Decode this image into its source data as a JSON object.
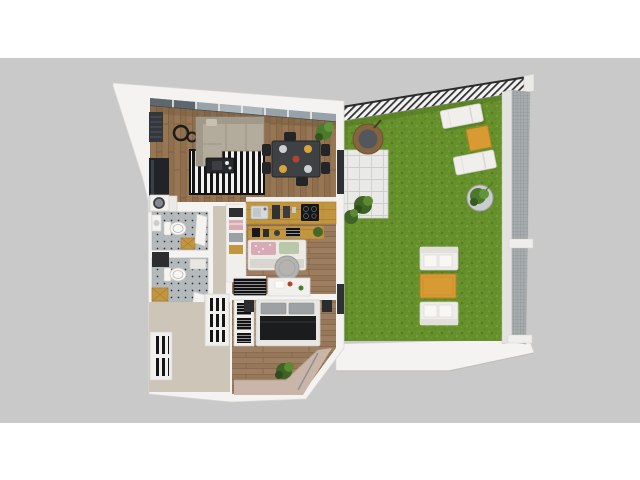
{
  "scene": {
    "type": "3d-floor-plan-render",
    "view": "top-down",
    "subject": "apartment floor plan with private garden terrace",
    "canvas": {
      "width": 640,
      "height": 480
    }
  },
  "palette": {
    "page_white": "#ffffff",
    "background_gray": "#c9c9c9",
    "wall_white": "#f4f3f1",
    "wall_edge": "#d8d6d2",
    "wood_floor": "#8f6f4e",
    "wood_floor_line": "#76593c",
    "bedroom_floor": "#97775a",
    "bedroom_floor_line": "#7d6046",
    "counter_wood": "#c2963f",
    "counter_wood_line": "#a87c2f",
    "sofa_beige": "#b3ac9c",
    "sofa_beige_dark": "#a19a8a",
    "rug_black": "#161616",
    "rug_white": "#f2f2f2",
    "table_dark": "#3f4245",
    "chair_dark": "#232527",
    "glazing_gray": "#98a2a9",
    "glazing_dark": "#5e676e",
    "bathroom_tile": "#b4b9bc",
    "bathroom_dot": "#2c2e30",
    "entry_floor": "#cdc5b8",
    "terrace_tan": "#c9b6a8",
    "lawn_green": "#66902c",
    "lawn_dark": "#567c22",
    "lawn_light": "#74a238",
    "patio_tile": "#e9e9e7",
    "patio_line": "#cfcfcc",
    "fence_white": "#f2f2f2",
    "fence_hatch": "#2e2e2e",
    "wall_mesh": "#a7acaf",
    "wall_mesh_line": "#82888c",
    "accent_orange": "#d89a33",
    "plant_green": "#4c7a2c",
    "plant_green_light": "#63943a",
    "plant_green_dark": "#35541d",
    "duvet_black": "#1b1c1e",
    "pillow_pink": "#d8aab4",
    "pillow_green": "#b9c9a8"
  },
  "apartment": {
    "rooms": [
      {
        "name": "living-room",
        "floor": "wood-planks",
        "items": [
          "corner-sofa",
          "striped-rug",
          "coffee-table",
          "dining-table",
          "dining-chairs-6",
          "wall-tv",
          "tv-cabinet",
          "radiator",
          "wall-art-rings",
          "potted-plant",
          "full-width-window"
        ]
      },
      {
        "name": "kitchen",
        "items": [
          "wood-counter",
          "sink",
          "cooktop",
          "small-appliances"
        ]
      },
      {
        "name": "bedroom",
        "floor": "wood-planks",
        "items": [
          "double-bed",
          "floral-pillow",
          "green-pillow",
          "wall-shelf",
          "closet",
          "desk",
          "round-rug",
          "bookshelf"
        ]
      },
      {
        "name": "bathroom-top",
        "floor": "dotted-tile",
        "items": [
          "toilet",
          "washbasin",
          "washing-machine",
          "wooden-laundry-box",
          "door"
        ]
      },
      {
        "name": "bathroom-bottom",
        "floor": "dotted-tile",
        "items": [
          "toilet",
          "shower-mat",
          "shelf",
          "wooden-laundry-box",
          "door"
        ]
      },
      {
        "name": "hallway-entry",
        "floor": "beige",
        "items": [
          "wardrobe-rack-1",
          "wardrobe-rack-2"
        ]
      },
      {
        "name": "second-bedroom",
        "floor": "wood-planks",
        "items": [
          "double-bed-dark-duvet",
          "nightstand-left",
          "nightstand-right",
          "bookcase"
        ]
      },
      {
        "name": "terrace-balcony",
        "floor": "tan-pavers",
        "items": [
          "potted-shrub",
          "diagonal-railing"
        ]
      }
    ]
  },
  "garden": {
    "ground": "lawn",
    "items": [
      "slatted-fence-top",
      "mesh-boundary-wall-right",
      "paved-patio",
      "log-planter",
      "patio-shrub-1",
      "patio-shrub-2",
      "sun-lounger-1",
      "sun-lounger-2",
      "orange-side-table",
      "garden-sofa-1",
      "garden-sofa-2",
      "orange-coffee-table",
      "round-planter",
      "paved-apron"
    ]
  }
}
